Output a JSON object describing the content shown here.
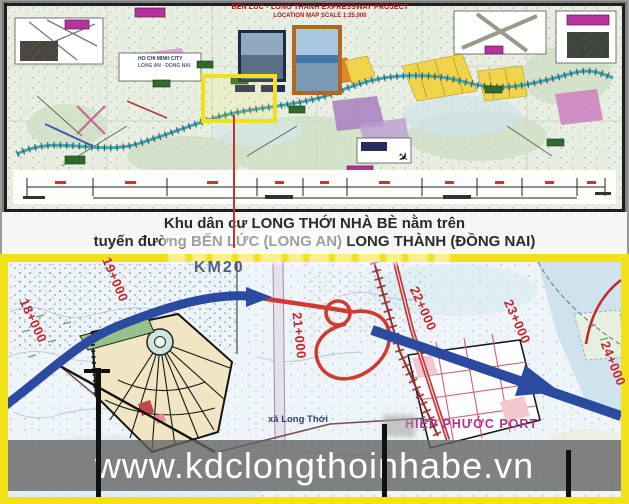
{
  "header_map": {
    "title_line1": "BEN LUC - LONG THANH EXPRESSWAY PROJECT",
    "title_line2": "LOCATION MAP SCALE 1:25.000",
    "city_label": "HO CHI MINH CITY",
    "city_sublabel": "LONG AN - DONG NAI"
  },
  "caption": {
    "line1": "Khu dân cư LONG THỚI NHÀ BÈ nằm trên",
    "line2": "tuyến đường BẾN LỨC (LONG AN) LONG THÀNH (ĐỒNG NAI)"
  },
  "detail_map": {
    "km_marker": "KM20",
    "chainage_labels": [
      "18+000",
      "19+000",
      "21+000",
      "22+000",
      "23+000",
      "24+000"
    ],
    "commune_label": "xã Long Thới",
    "port_label": "HIỆP PHƯỚC PORT"
  },
  "footer": {
    "website": "www.kdclongthoinhabe.vn"
  },
  "colors": {
    "frame_yellow": "#f2e018",
    "expressway_blue": "#2b4ba0",
    "route_red": "#c5242b",
    "port_magenta": "#b1338f",
    "banner_gray": "#626262"
  }
}
